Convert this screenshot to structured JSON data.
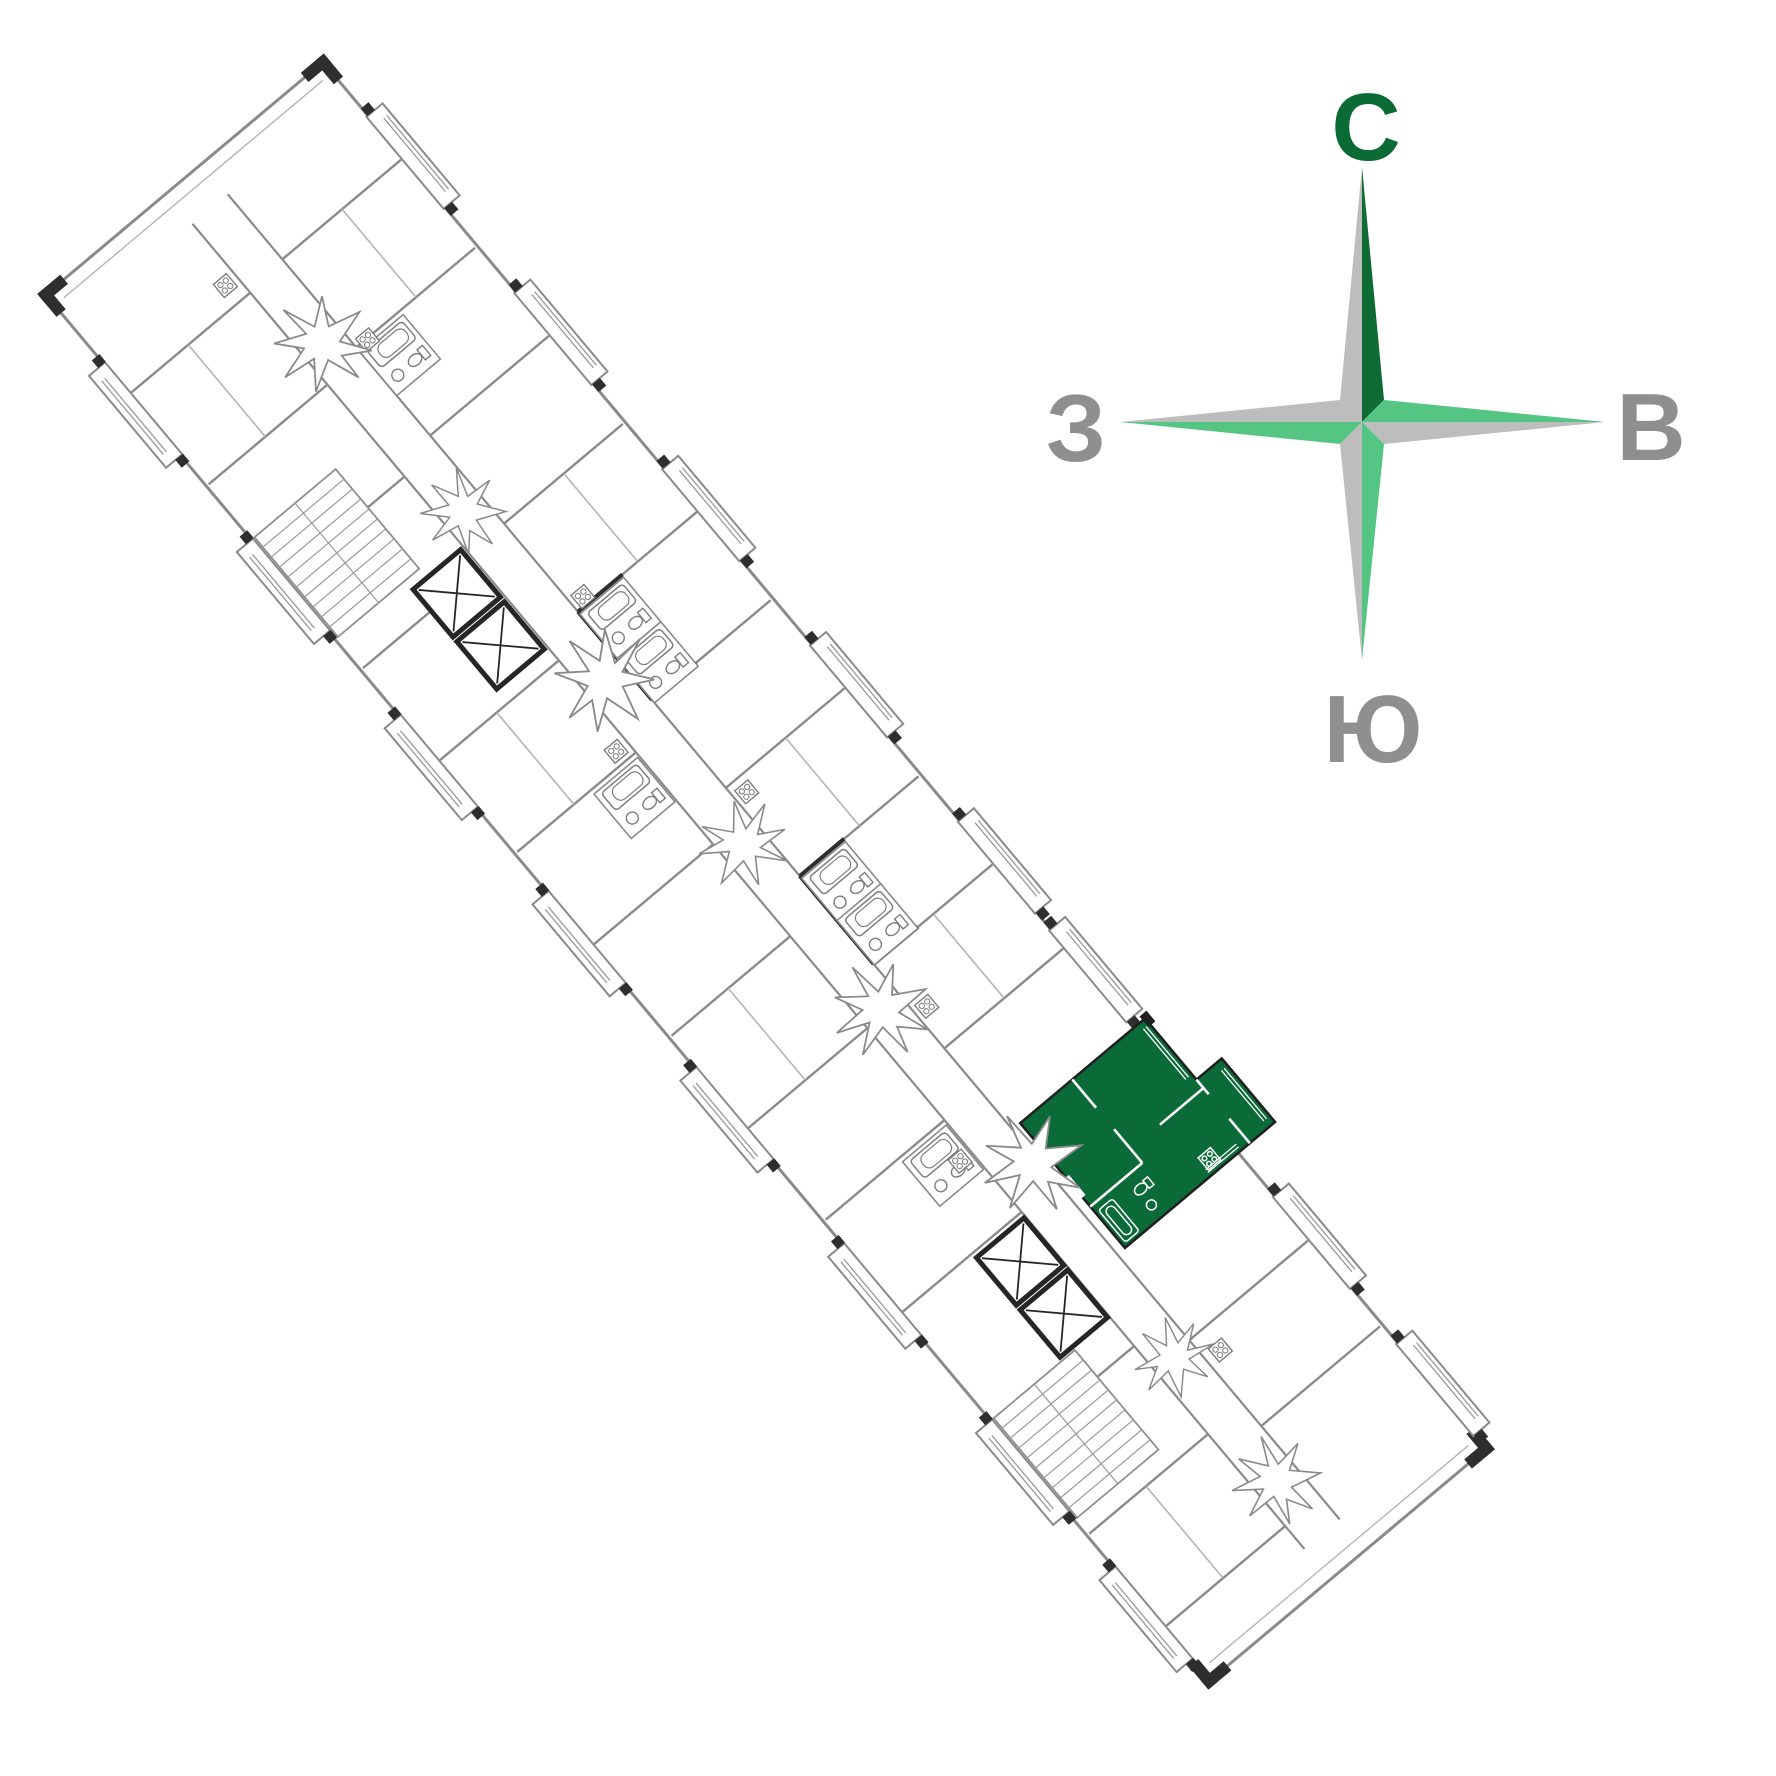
{
  "page": {
    "title": "Floor plan with highlighted apartment",
    "background": "#FFFFFF"
  },
  "compass": {
    "north_label": "С",
    "east_label": "В",
    "west_label": "З",
    "south_label": "Ю",
    "north_letter_color": "#0B6B35",
    "letter_gray": "#8F8F8F",
    "arm_dark_green": "#0E6B33",
    "arm_light_green": "#55C584",
    "arm_gray": "#BDBDBD"
  },
  "floor_plan": {
    "highlighted_unit_color": "#0B6B38",
    "wall_color": "#8A8A8A",
    "accent_wall_color": "#2E2E2E",
    "fixture_line_color": "#7E7E7E"
  }
}
